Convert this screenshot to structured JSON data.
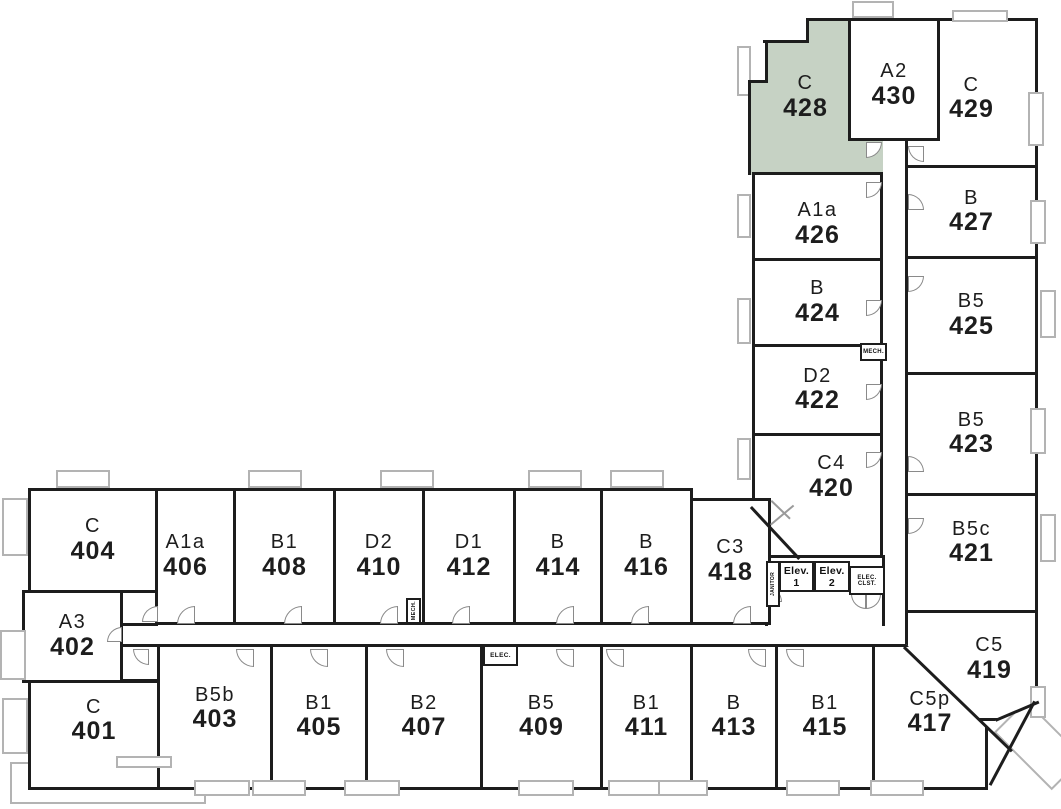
{
  "plan": {
    "highlighted_unit": "428",
    "colors": {
      "wall": "#1d1d1d",
      "highlight": "#c6d2c4",
      "window": "#b3b3b3",
      "door": "#8a8a8a"
    }
  },
  "rooms": [
    {
      "type": "C",
      "num": "429",
      "x": 905,
      "y": 18,
      "w": 133,
      "h": 150,
      "dy": 6
    },
    {
      "type": "C",
      "num": "428",
      "x": 748,
      "y": 20,
      "w": 135,
      "h": 155,
      "hl": true,
      "nb": true,
      "dx": -10,
      "clip": "polygon(58px 0, 135px 0, 135px 155px, 0 155px, 0 62px, 17px 62px, 17px 22px, 58px 22px)"
    },
    {
      "type": "A2",
      "num": "430",
      "x": 848,
      "y": 18,
      "w": 92,
      "h": 123,
      "dy": 6
    },
    {
      "type": "A1a",
      "num": "426",
      "x": 752,
      "y": 172,
      "w": 131,
      "h": 89,
      "dy": 8
    },
    {
      "type": "B",
      "num": "424",
      "x": 752,
      "y": 258,
      "w": 131,
      "h": 89
    },
    {
      "type": "D2",
      "num": "422",
      "x": 752,
      "y": 344,
      "w": 131,
      "h": 92
    },
    {
      "type": "C4",
      "num": "420",
      "x": 752,
      "y": 433,
      "w": 131,
      "h": 125,
      "dx": 14,
      "dy": -18,
      "clip": "polygon(0 0, 131px 0, 131px 125px, 48px 125px, 17px 93px, 0 73px)"
    },
    {
      "type": "B",
      "num": "427",
      "x": 905,
      "y": 165,
      "w": 133,
      "h": 94
    },
    {
      "type": "B5",
      "num": "425",
      "x": 905,
      "y": 256,
      "w": 133,
      "h": 119
    },
    {
      "type": "B5",
      "num": "423",
      "x": 905,
      "y": 372,
      "w": 133,
      "h": 124
    },
    {
      "type": "B5c",
      "num": "421",
      "x": 905,
      "y": 493,
      "w": 133,
      "h": 120,
      "dy": -10
    },
    {
      "type": "C5",
      "num": "419",
      "x": 905,
      "y": 610,
      "w": 133,
      "h": 111,
      "dx": 18,
      "dy": -6,
      "clip": "polygon(0 0, 133px 0, 133px 92px, 90px 111px, 0 111px)"
    },
    {
      "type": "C",
      "num": "404",
      "x": 28,
      "y": 488,
      "w": 130,
      "h": 105
    },
    {
      "type": "A3",
      "num": "402",
      "x": 22,
      "y": 590,
      "w": 101,
      "h": 93
    },
    {
      "type": "C",
      "num": "401",
      "x": 28,
      "y": 680,
      "w": 132,
      "h": 110,
      "dy": -14
    },
    {
      "type": "A1a",
      "num": "406",
      "x": 155,
      "y": 488,
      "w": 81,
      "h": 137,
      "dx": -10
    },
    {
      "type": "B1",
      "num": "408",
      "x": 233,
      "y": 488,
      "w": 103,
      "h": 137
    },
    {
      "type": "D2",
      "num": "410",
      "x": 333,
      "y": 488,
      "w": 92,
      "h": 137
    },
    {
      "type": "D1",
      "num": "412",
      "x": 422,
      "y": 488,
      "w": 94,
      "h": 137
    },
    {
      "type": "B",
      "num": "414",
      "x": 513,
      "y": 488,
      "w": 90,
      "h": 137
    },
    {
      "type": "B",
      "num": "416",
      "x": 600,
      "y": 488,
      "w": 93,
      "h": 137
    },
    {
      "type": "C3",
      "num": "418",
      "x": 690,
      "y": 498,
      "w": 81,
      "h": 127
    },
    {
      "type": "B5b",
      "num": "403",
      "x": 157,
      "y": 644,
      "w": 116,
      "h": 146,
      "dy": -8
    },
    {
      "type": "B1",
      "num": "405",
      "x": 270,
      "y": 644,
      "w": 98,
      "h": 146
    },
    {
      "type": "B2",
      "num": "407",
      "x": 365,
      "y": 644,
      "w": 118,
      "h": 146
    },
    {
      "type": "B5",
      "num": "409",
      "x": 480,
      "y": 644,
      "w": 123,
      "h": 146
    },
    {
      "type": "B1",
      "num": "411",
      "x": 600,
      "y": 644,
      "w": 93,
      "h": 146
    },
    {
      "type": "B",
      "num": "413",
      "x": 690,
      "y": 644,
      "w": 88,
      "h": 146
    },
    {
      "type": "B1",
      "num": "415",
      "x": 775,
      "y": 644,
      "w": 100,
      "h": 146
    },
    {
      "type": "C5p",
      "num": "417",
      "x": 872,
      "y": 644,
      "w": 116,
      "h": 146,
      "dy": -4,
      "clip": "polygon(0 0, 34px 0, 116px 85px, 116px 146px, 0 146px)"
    }
  ],
  "shapes": [
    {
      "name": "entry-nook-404",
      "x": 120,
      "y": 590,
      "w": 38,
      "h": 36,
      "cls": ""
    },
    {
      "name": "entry-nook-401",
      "x": 118,
      "y": 644,
      "w": 44,
      "h": 38,
      "cls": ""
    },
    {
      "name": "elevator-lobby",
      "x": 765,
      "y": 555,
      "w": 120,
      "h": 71,
      "cls": "open-bottom"
    },
    {
      "name": "balcony-top",
      "x": 852,
      "y": 1,
      "w": 42,
      "h": 17,
      "cls": "gray hollow open-bottom"
    },
    {
      "name": "patio-bottom-left",
      "x": 10,
      "y": 762,
      "w": 196,
      "h": 42,
      "cls": "gray hollow"
    },
    {
      "name": "balcony-corner",
      "x": 998,
      "y": 722,
      "w": 82,
      "h": 46,
      "cls": "gray hollow rot45"
    }
  ],
  "walls": [
    [
      806,
      18,
      45,
      3,
      0
    ],
    [
      806,
      18,
      3,
      25,
      0
    ],
    [
      763,
      40,
      46,
      3,
      0
    ],
    [
      765,
      40,
      3,
      43,
      0
    ],
    [
      748,
      80,
      20,
      3,
      0
    ],
    [
      748,
      80,
      3,
      95,
      0
    ],
    [
      752,
      506,
      71,
      3,
      47
    ],
    [
      995,
      719,
      47,
      3,
      -23
    ],
    [
      905,
      646,
      150,
      3,
      44
    ],
    [
      1036,
      702,
      95,
      3,
      118
    ]
  ],
  "leafs": [
    [
      770,
      524,
      30,
      -40
    ],
    [
      772,
      500,
      26,
      44
    ]
  ],
  "doors": [
    [
      142,
      606,
      "tl",
      16
    ],
    [
      177,
      606,
      "tl",
      18
    ],
    [
      284,
      606,
      "tl",
      18
    ],
    [
      380,
      606,
      "tl",
      18
    ],
    [
      452,
      606,
      "tl",
      18
    ],
    [
      556,
      606,
      "tl",
      18
    ],
    [
      631,
      606,
      "tl",
      18
    ],
    [
      733,
      606,
      "tl",
      18
    ],
    [
      133,
      649,
      "bl",
      16
    ],
    [
      236,
      649,
      "bl",
      18
    ],
    [
      310,
      649,
      "bl",
      18
    ],
    [
      386,
      649,
      "bl",
      18
    ],
    [
      556,
      649,
      "bl",
      18
    ],
    [
      606,
      649,
      "bl",
      18
    ],
    [
      748,
      649,
      "bl",
      18
    ],
    [
      786,
      649,
      "bl",
      18
    ],
    [
      107,
      627,
      "tl",
      15
    ],
    [
      866,
      182,
      "br",
      16
    ],
    [
      866,
      300,
      "br",
      16
    ],
    [
      866,
      384,
      "br",
      16
    ],
    [
      866,
      452,
      "br",
      16
    ],
    [
      908,
      194,
      "tr",
      16
    ],
    [
      908,
      276,
      "br",
      16
    ],
    [
      908,
      456,
      "tr",
      16
    ],
    [
      908,
      518,
      "br",
      16
    ],
    [
      866,
      142,
      "br",
      16
    ],
    [
      908,
      146,
      "bl",
      16
    ],
    [
      766,
      586,
      "tr",
      16
    ],
    [
      851,
      594,
      "bl",
      15
    ],
    [
      866,
      594,
      "br",
      15
    ]
  ],
  "windows": [
    [
      952,
      10,
      56,
      12
    ],
    [
      737,
      46,
      14,
      50
    ],
    [
      737,
      194,
      14,
      44
    ],
    [
      737,
      298,
      14,
      46
    ],
    [
      737,
      438,
      14,
      42
    ],
    [
      1028,
      92,
      16,
      54
    ],
    [
      1030,
      200,
      16,
      44
    ],
    [
      1040,
      290,
      16,
      48
    ],
    [
      1030,
      408,
      16,
      46
    ],
    [
      1040,
      514,
      16,
      48
    ],
    [
      1030,
      686,
      16,
      32
    ],
    [
      56,
      470,
      54,
      18
    ],
    [
      248,
      470,
      54,
      18
    ],
    [
      380,
      470,
      54,
      18
    ],
    [
      528,
      470,
      54,
      18
    ],
    [
      610,
      470,
      54,
      18
    ],
    [
      2,
      498,
      26,
      58
    ],
    [
      0,
      630,
      26,
      50
    ],
    [
      2,
      698,
      26,
      56
    ],
    [
      116,
      756,
      56,
      12
    ],
    [
      194,
      780,
      56,
      16
    ],
    [
      252,
      780,
      54,
      16
    ],
    [
      344,
      780,
      56,
      16
    ],
    [
      518,
      780,
      56,
      16
    ],
    [
      608,
      780,
      54,
      16
    ],
    [
      658,
      780,
      50,
      16
    ],
    [
      786,
      780,
      54,
      16
    ],
    [
      870,
      780,
      54,
      16
    ]
  ],
  "service_boxes": [
    {
      "label": "MECH.",
      "x": 860,
      "y": 343,
      "w": 27,
      "h": 18,
      "fs": 6,
      "vert": false,
      "name": "mech-closet-upper"
    },
    {
      "label": "MECH.",
      "x": 406,
      "y": 598,
      "w": 15,
      "h": 26,
      "fs": 5.5,
      "vert": true,
      "name": "mech-closet-lower"
    },
    {
      "label": "ELEC.",
      "x": 483,
      "y": 645,
      "w": 35,
      "h": 21,
      "fs": 6.5,
      "vert": false,
      "name": "elec-closet"
    },
    {
      "label": "Elev. 1",
      "x": 779,
      "y": 561,
      "w": 35,
      "h": 31,
      "fs": 10.5,
      "vert": false,
      "name": "elevator-1"
    },
    {
      "label": "Elev. 2",
      "x": 814,
      "y": 561,
      "w": 36,
      "h": 31,
      "fs": 10.5,
      "vert": false,
      "name": "elevator-2"
    },
    {
      "label": "ELEC. CLST.",
      "x": 849,
      "y": 566,
      "w": 36,
      "h": 29,
      "fs": 6,
      "vert": false,
      "name": "elec-clst"
    },
    {
      "label": "JANITOR",
      "x": 766,
      "y": 561,
      "w": 14,
      "h": 46,
      "fs": 5,
      "vert": true,
      "name": "janitor-closet"
    }
  ]
}
